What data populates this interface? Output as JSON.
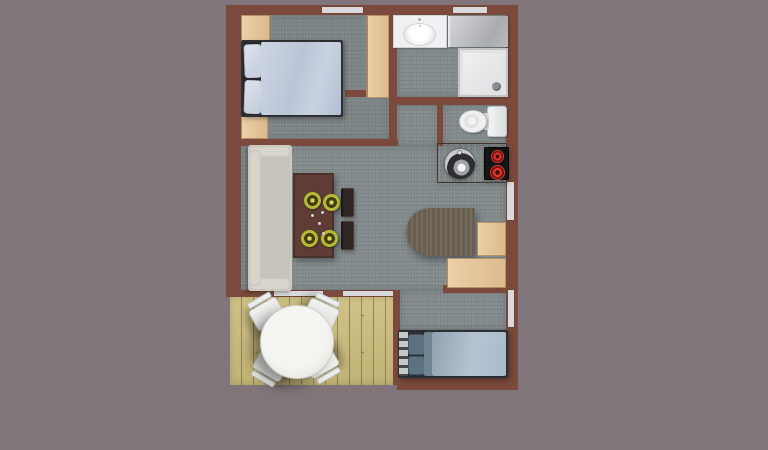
{
  "scene": {
    "title": "studio-apartment-floor-plan-top-view",
    "background_color": "#7f757b",
    "colors": {
      "bg": "#7f757b",
      "wall": "#7b4a3d",
      "floor_brown": "#8a5a4c",
      "carpet": "#828a8c",
      "deck_wood": "#cdbe7d",
      "wood_light": "#ecd0a7",
      "counter_wood": "#6f5f51",
      "desk_wood": "#6f6457",
      "dining_table": "#5f3d36",
      "chair_dark": "#2f2522",
      "sofa": "#cfcbc3",
      "sofa_cushion": "#c8c4bc",
      "sofa_trim": "#d9d5cd",
      "bed_frame": "#2f2f33",
      "duvet_light": "#bac5d7",
      "pillow_light": "#dde3ec",
      "bed2_frame": "#2b2e32",
      "duvet2": "#b6c4d2",
      "pillow_teal": "#5c7280",
      "fixture_white": "#eef0f2",
      "glass_gray": "#a9abae",
      "window_white": "#d9d9db",
      "plate_yellow": "#b4ba30",
      "plate_dark": "#453c12",
      "burner_red": "#e03a2a",
      "cooktop_black": "#141416",
      "steel": "#97999b"
    },
    "rooms": [
      {
        "id": "bedroom-1",
        "label": "bedroom with double bed",
        "furniture": [
          "double-bed",
          "pillow x2",
          "wardrobe-top-left",
          "tall-wardrobe-right",
          "wardrobe-bottom-left"
        ]
      },
      {
        "id": "bathroom",
        "label": "bathroom",
        "furniture": [
          "vanity-sink",
          "glass-panel",
          "shower-tray"
        ]
      },
      {
        "id": "wc",
        "label": "toilet room",
        "furniture": [
          "toilet"
        ]
      },
      {
        "id": "kitchen",
        "label": "kitchenette",
        "furniture": [
          "kitchen-counter",
          "round-sink",
          "two-burner-cooktop"
        ]
      },
      {
        "id": "living-room",
        "label": "living / dining area",
        "furniture": [
          "sofa",
          "dining-table",
          "place-setting x4",
          "dining-chair x2",
          "round-end-desk",
          "side-cabinet",
          "low-cabinet"
        ]
      },
      {
        "id": "bedroom-2",
        "label": "bedroom with single bed",
        "furniture": [
          "single-bed",
          "pillow x2"
        ]
      },
      {
        "id": "deck",
        "label": "wooden deck / terrace",
        "furniture": [
          "round-table",
          "deck-chair x4"
        ]
      }
    ],
    "openings": {
      "top_windows": 2,
      "right_windows": 2,
      "deck_glass_doors": 2
    }
  }
}
